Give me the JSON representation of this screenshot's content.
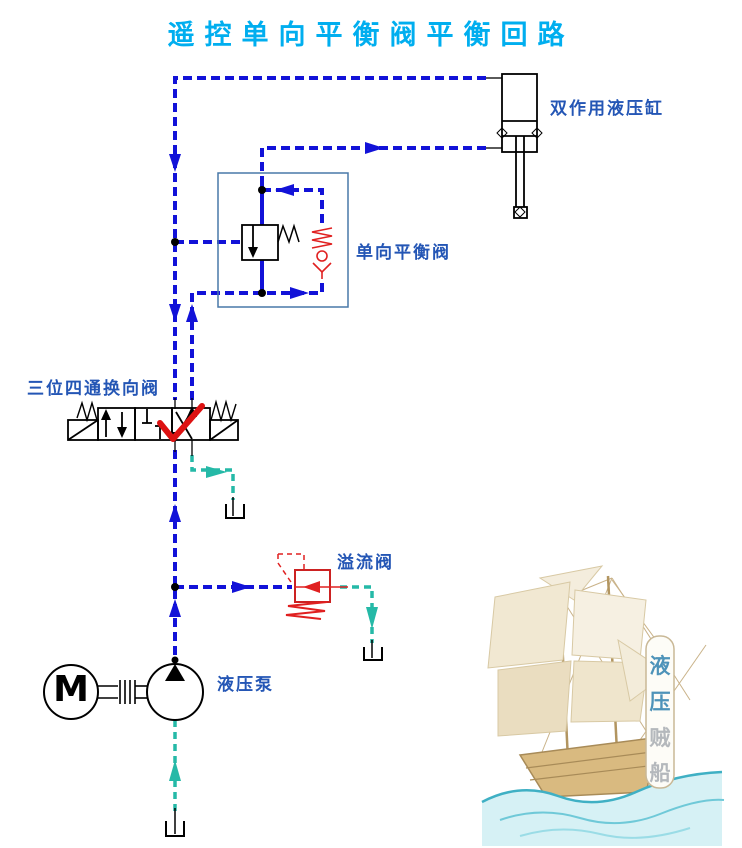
{
  "title": "遥控单向平衡阀平衡回路",
  "labels": {
    "cylinder": "双作用液压缸",
    "balance_valve": "单向平衡阀",
    "directional_valve": "三位四通换向阀",
    "relief_valve": "溢流阀",
    "pump": "液压泵"
  },
  "pump": {
    "motor_letter": "M"
  },
  "watermark": {
    "chars": [
      "液",
      "压",
      "贼",
      "船"
    ]
  },
  "colors": {
    "title_cyan": "#00AEEF",
    "label_blue": "#2456B5",
    "line_blue": "#1212D8",
    "line_teal": "#25B9A7",
    "line_red": "#E02020",
    "balance_box_blue": "#4878A8",
    "black": "#000000"
  }
}
